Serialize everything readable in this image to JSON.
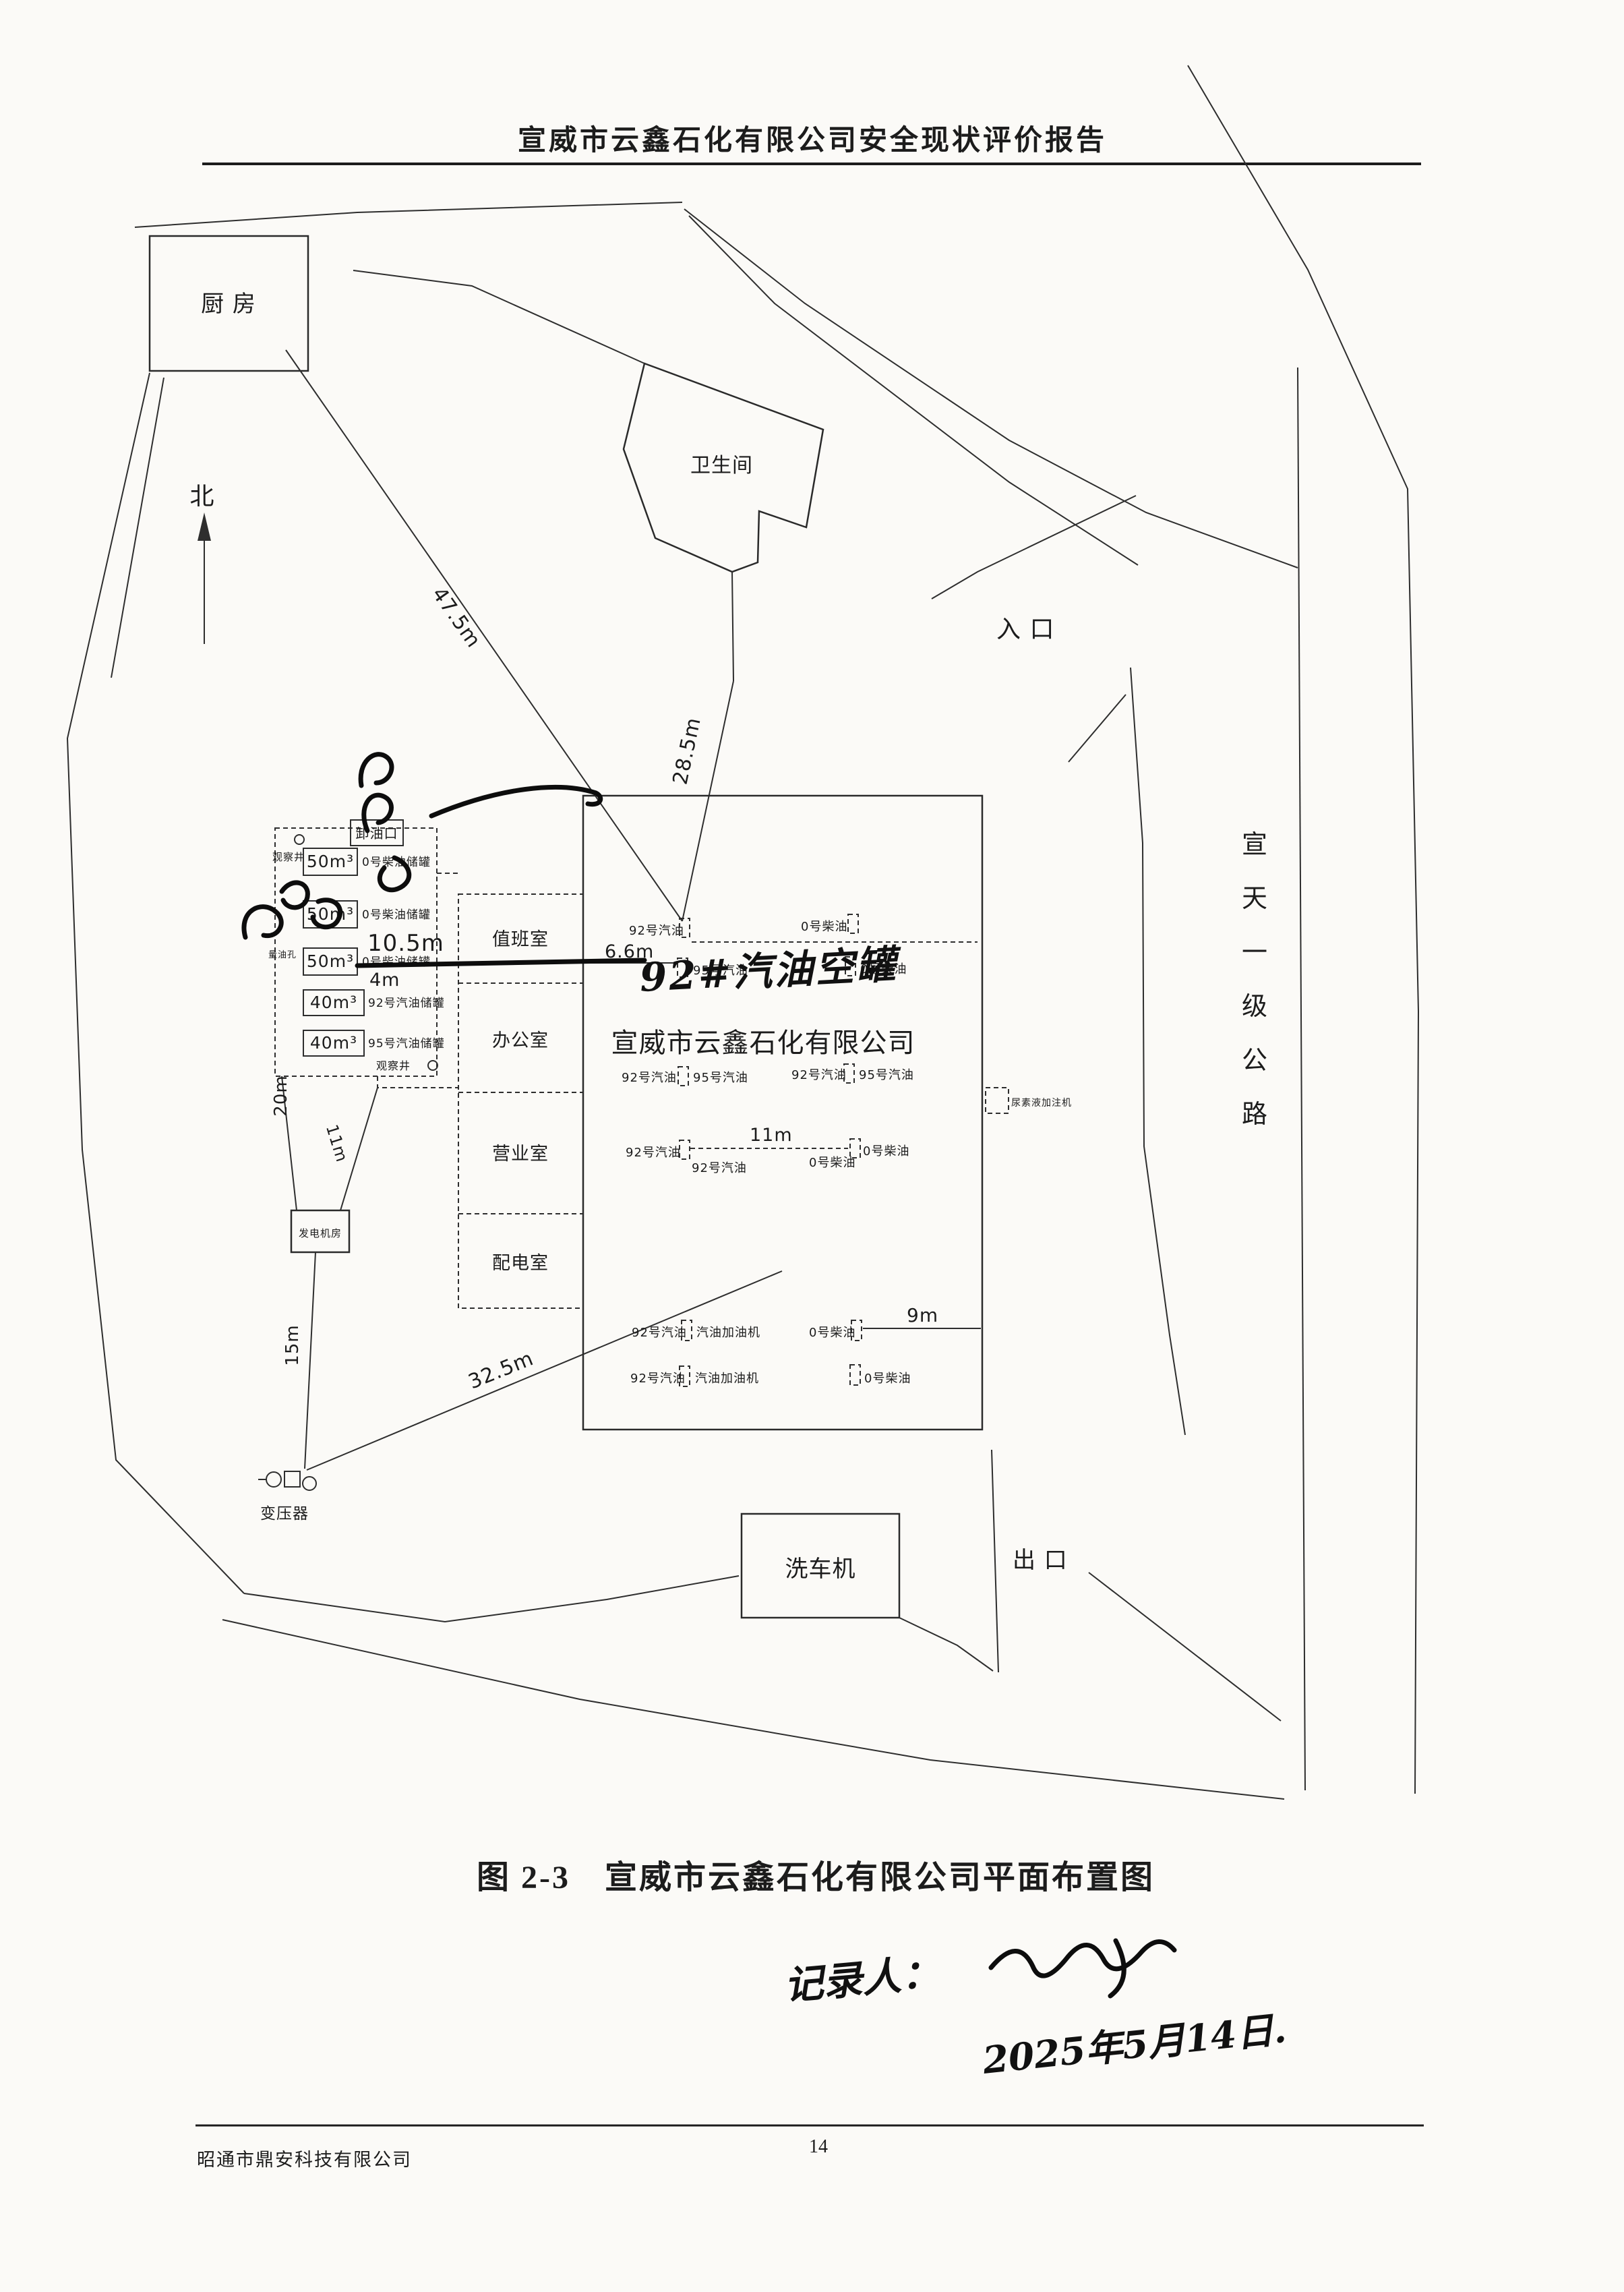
{
  "header": {
    "title": "宣威市云鑫石化有限公司安全现状评价报告"
  },
  "plan": {
    "north": "北",
    "kitchen": "厨  房",
    "toilet": "卫生间",
    "entrance": "入  口",
    "exit": "出  口",
    "car_washer": "洗车机",
    "highway": [
      "宣",
      "天",
      "一",
      "级",
      "公",
      "路"
    ],
    "dims": {
      "d475": "47.5m",
      "d285": "28.5m",
      "d105": "10.5m",
      "d4": "4m",
      "d20": "20m",
      "d11yard": "11m",
      "d15": "15m",
      "d325": "32.5m",
      "d66": "6.6m",
      "d11": "11m",
      "d9": "9m"
    },
    "tank_area": {
      "unloading_port": "卸油口",
      "well_top": "观察井",
      "well_bottom": "观察井",
      "gauge_well": "量油孔",
      "tanks": [
        {
          "volume": "50m³",
          "label": "0号柴油储罐"
        },
        {
          "volume": "50m³",
          "label": "0号柴油储罐"
        },
        {
          "volume": "50m³",
          "label": "0号柴油储罐"
        },
        {
          "volume": "40m³",
          "label": "92号汽油储罐"
        },
        {
          "volume": "40m³",
          "label": "95号汽油储罐"
        }
      ]
    },
    "yard": {
      "generator_room": "发电机房",
      "transformer": "变压器"
    },
    "rooms": [
      "值班室",
      "办公室",
      "营业室",
      "配电室"
    ],
    "canopy": {
      "company": "宣威市云鑫石化有限公司",
      "g92": "92号汽油",
      "g95": "95号汽油",
      "d0": "0号柴油",
      "pump": "汽油加油机",
      "urea": "尿素液加注机"
    }
  },
  "annotations": {
    "strike_note": "92#汽油空罐",
    "recorder": "记录人：",
    "date": "2025年5月14日."
  },
  "caption": "图 2-3　宣威市云鑫石化有限公司平面布置图",
  "footer": {
    "company": "昭通市鼎安科技有限公司",
    "page": "14"
  }
}
